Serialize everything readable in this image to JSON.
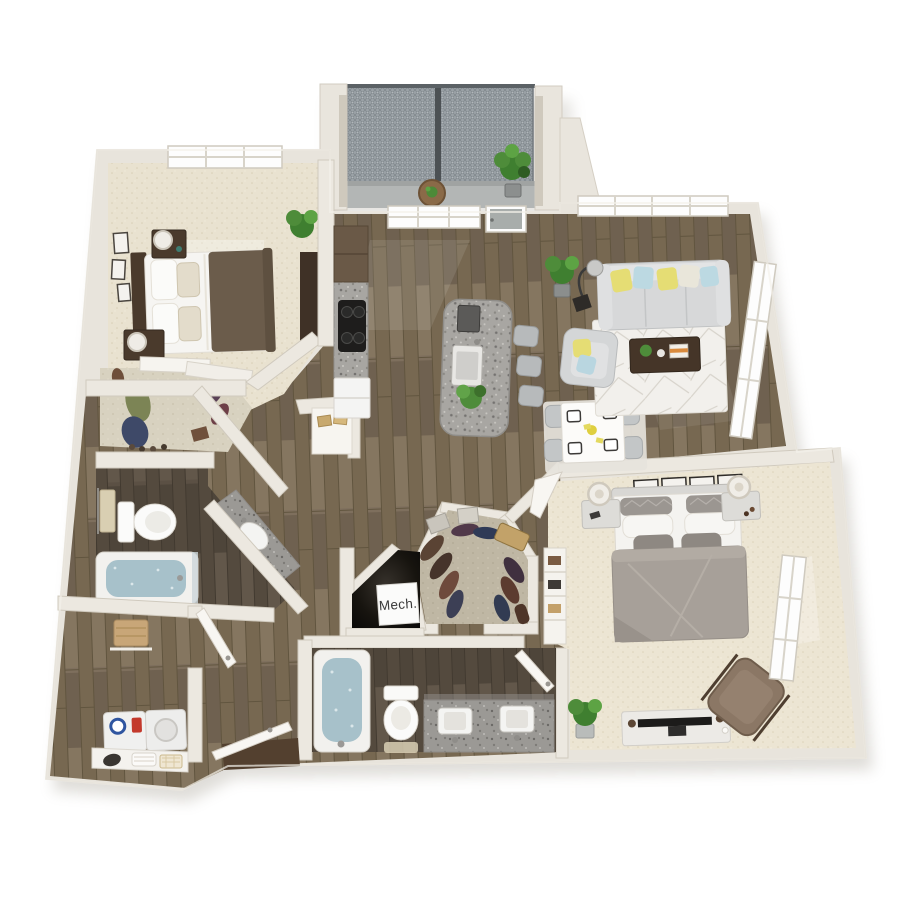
{
  "scene": {
    "type": "3D apartment floor plan rendering, top-down view",
    "background": "#ffffff"
  },
  "labels": {
    "mech_room": "Mech."
  },
  "palette": {
    "wall": "#e8e4dc",
    "wall_edge": "#d0cabe",
    "wood_floor": "#7d6e5c",
    "wood_floor_dark": "#5a4f42",
    "carpet_light": "#e9e2d0",
    "carpet_master": "#ece5d3",
    "carpet_walkin_closet": "#bfb7a4",
    "granite": "#a8a6a2",
    "cabinet_brown": "#6a5947",
    "sofa_gray": "#d7d8d9",
    "accent_yellow": "#e5dd74",
    "accent_blue": "#bcd9e2",
    "master_bed_gray": "#a7a099",
    "bed1_blanket_brown": "#6b5c4b",
    "dark_wood_furniture": "#453528",
    "armchair_brown": "#8b7765",
    "bath_water_blue": "#a7c1ca",
    "balcony_mesh_gray": "#99a0a5",
    "balcony_floor_gray": "#b3b6b5",
    "plant_green": "#4e8c3a",
    "washer_dial_blue": "#2f55a0",
    "detergent_red": "#c3392c",
    "mech_label_text": "#3a3a3a"
  }
}
